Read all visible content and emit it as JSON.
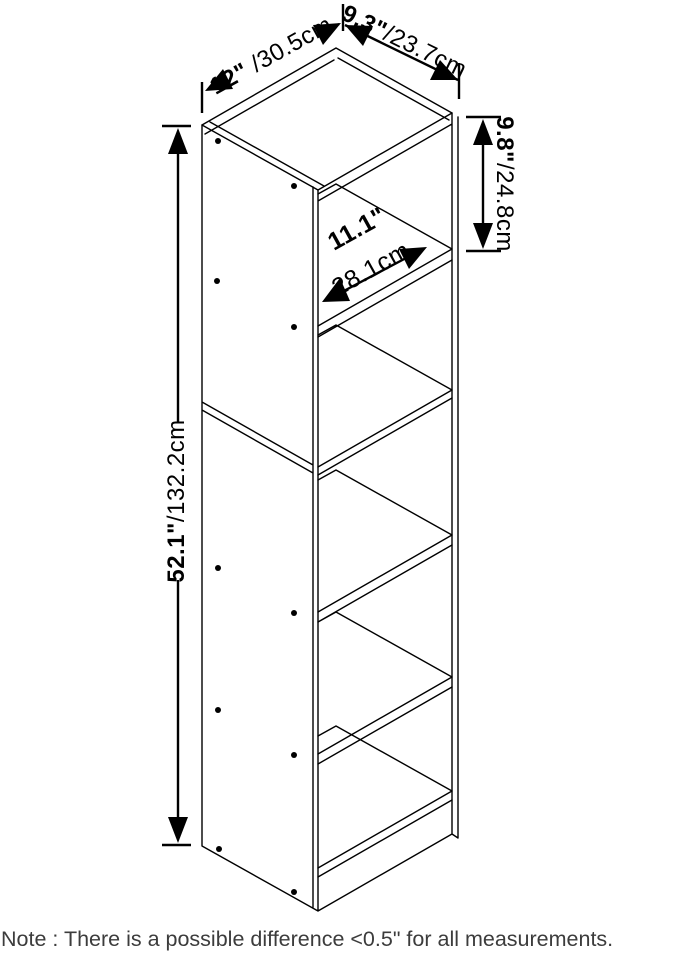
{
  "drawing": {
    "product": "5-cube storage shelf dimension diagram",
    "note": "Note : There is a possible difference <0.5\" for all measurements.",
    "dimensions": {
      "top_width": {
        "inches": "12\"",
        "cm": " /30.5cm"
      },
      "top_depth": {
        "inches": "9.3\"",
        "cm": "/23.7cm"
      },
      "compartment_height": {
        "inches": "9.8\"",
        "cm": "/24.8cm"
      },
      "compartment_width": {
        "inches": "11.1\"",
        "cm": "28.1cm"
      },
      "total_height": {
        "inches": "52.1\"",
        "cm": "/132.2cm"
      }
    },
    "colors": {
      "line": "#000000",
      "note_text": "#3c3c3c",
      "background": "#ffffff"
    }
  }
}
